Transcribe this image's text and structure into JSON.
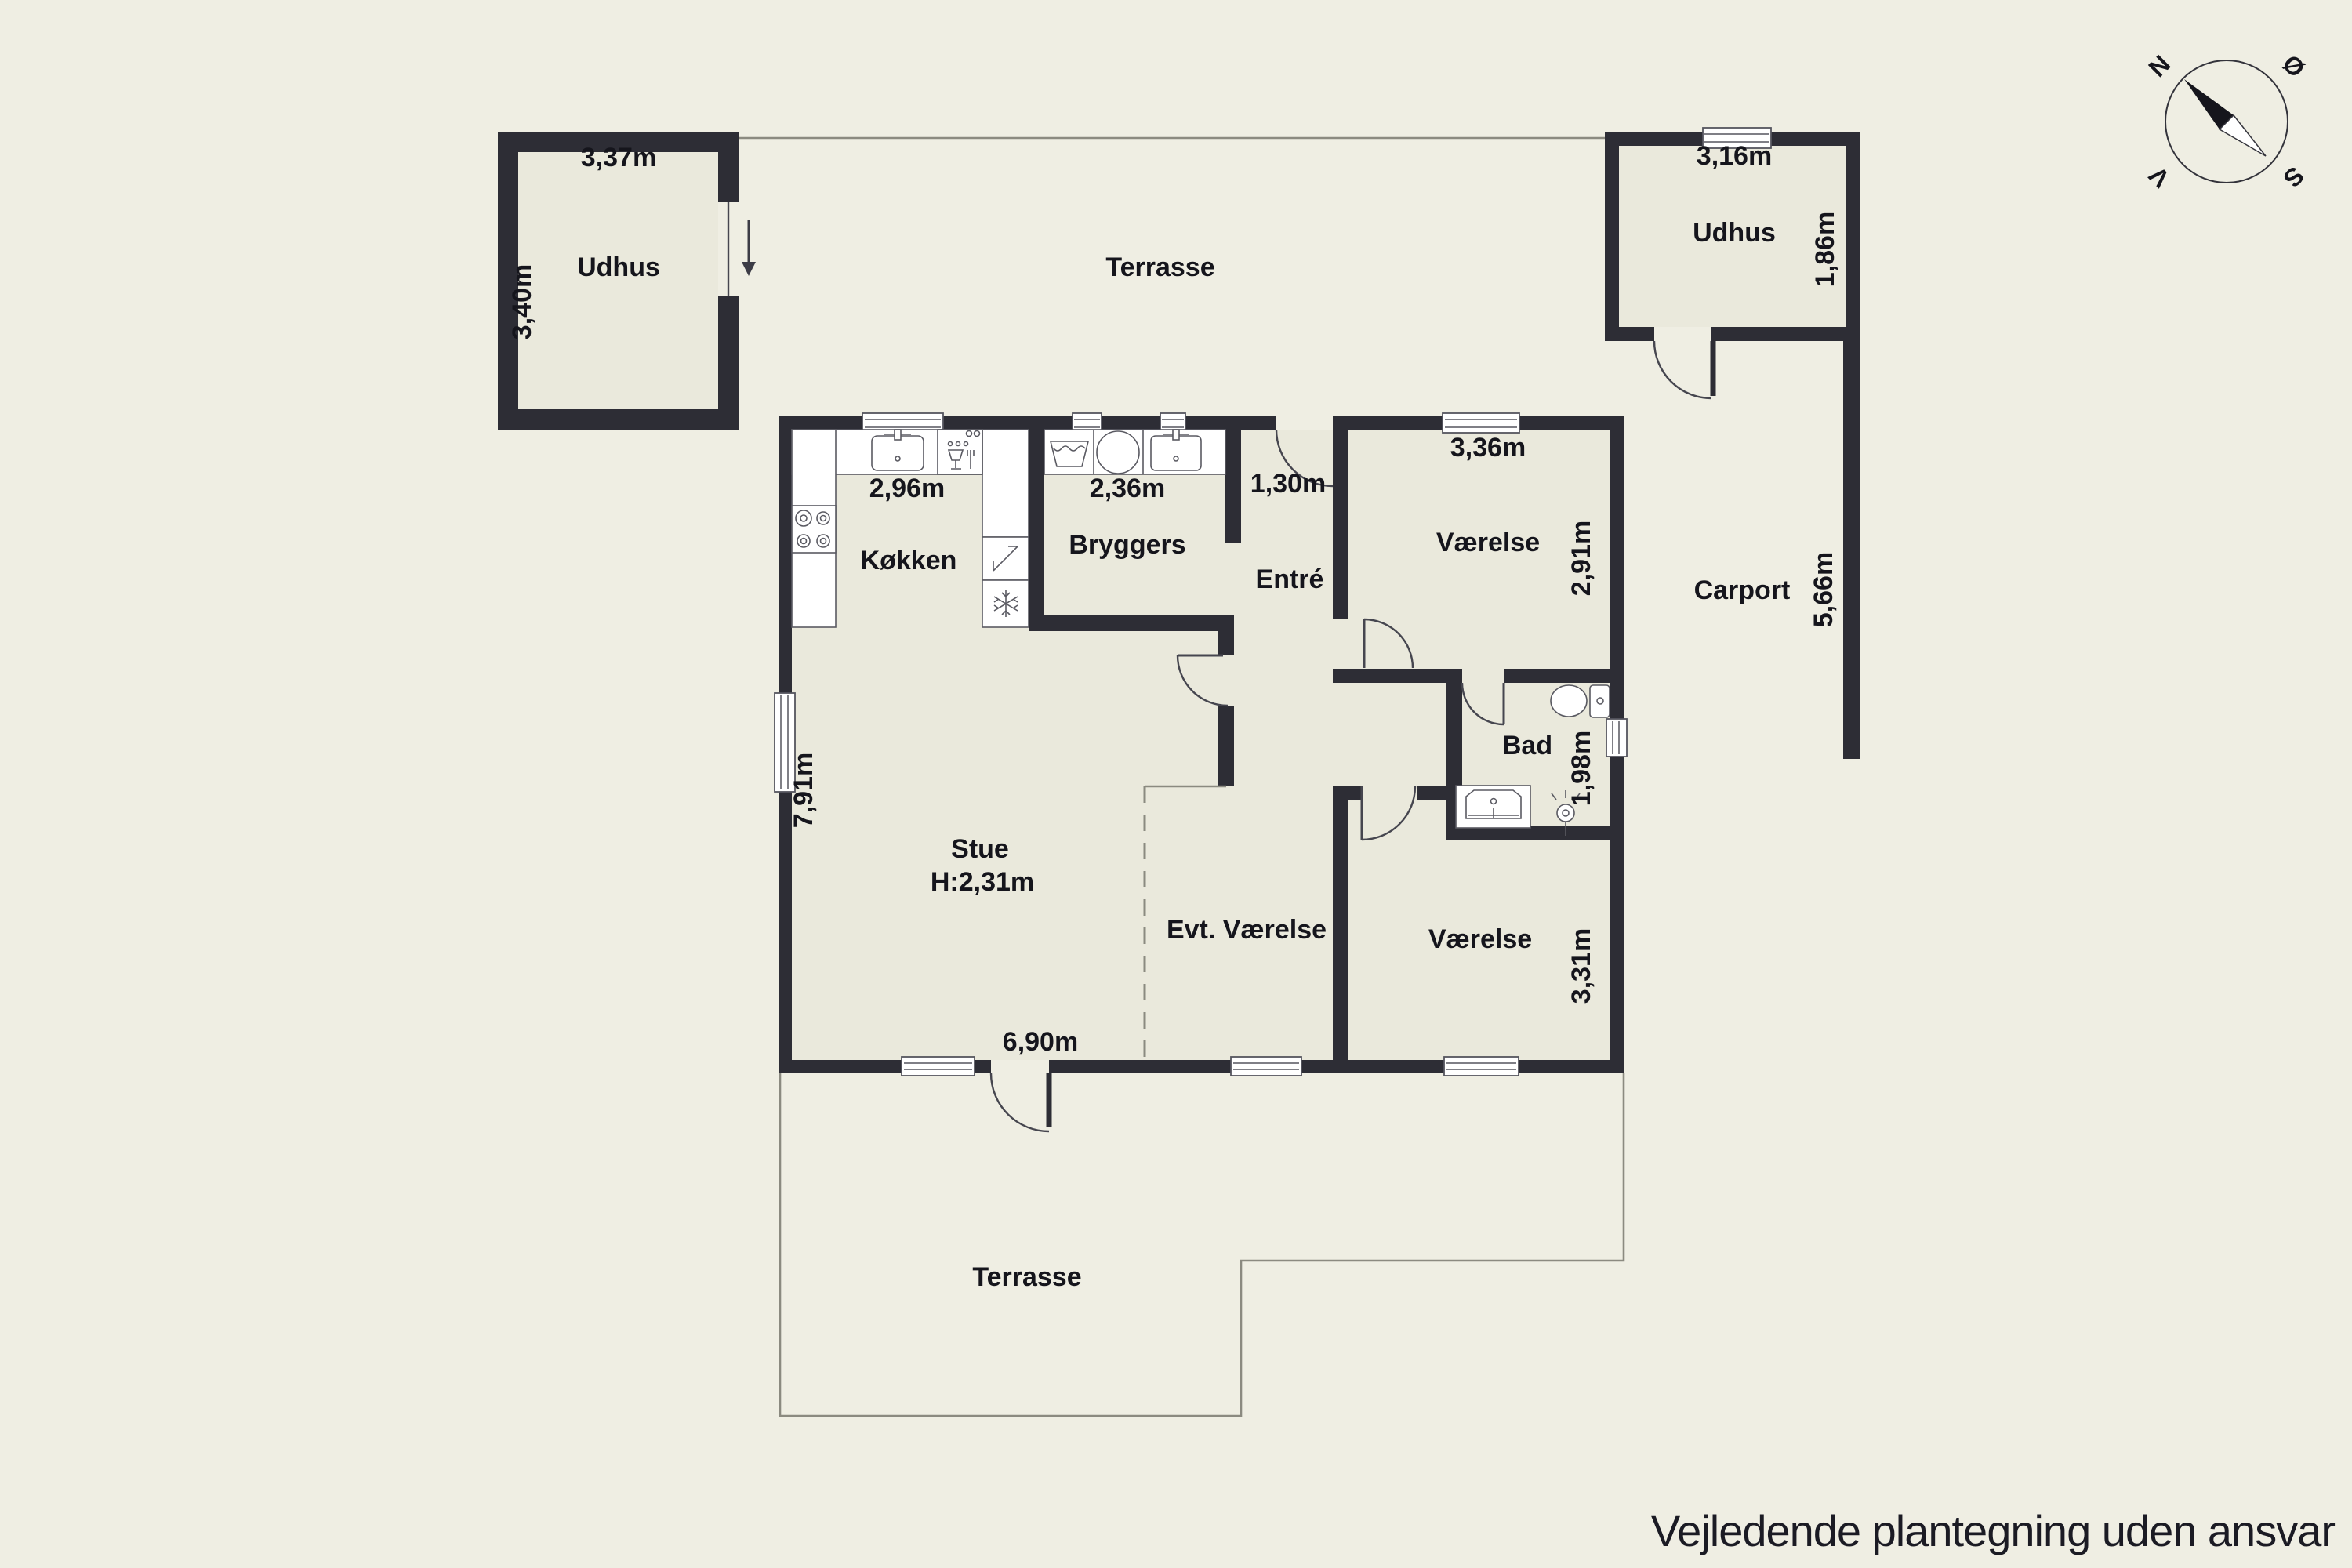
{
  "page": {
    "footer_note": "Vejledende plantegning uden ansvar",
    "background_color": "#efeee3",
    "wall_color": "#2d2d35",
    "room_fill_color": "#eae9dc"
  },
  "compass": {
    "north": "N",
    "east": "Ø",
    "south": "S",
    "west": "V"
  },
  "rooms": {
    "udhus_left": {
      "label": "Udhus",
      "width": "3,37m",
      "depth": "3,40m"
    },
    "terrasse_top": {
      "label": "Terrasse"
    },
    "udhus_right": {
      "label": "Udhus",
      "width": "3,16m",
      "depth": "1,86m"
    },
    "carport": {
      "label": "Carport",
      "length": "5,66m"
    },
    "koekken": {
      "label": "Køkken",
      "width": "2,96m"
    },
    "bryggers": {
      "label": "Bryggers",
      "width": "2,36m"
    },
    "entre": {
      "label": "Entré",
      "width": "1,30m"
    },
    "vaerelse_ne": {
      "label": "Værelse",
      "width": "3,36m",
      "depth": "2,91m"
    },
    "bad": {
      "label": "Bad",
      "depth": "1,98m"
    },
    "stue": {
      "label": "Stue",
      "ceiling_height": "H:2,31m",
      "depth": "7,91m",
      "width": "6,90m"
    },
    "evt_vaerelse": {
      "label": "Evt. Værelse"
    },
    "vaerelse_se": {
      "label": "Værelse",
      "depth": "3,31m"
    },
    "terrasse_bottom": {
      "label": "Terrasse"
    }
  },
  "icons": {
    "compass": "compass-rose-icon",
    "entrance_arrow": "entrance-arrow-icon",
    "kitchen_sink": "kitchen-sink-icon",
    "dishwasher": "dishwasher-icon",
    "stove": "stove-icon",
    "electrical_panel": "electrical-panel-icon",
    "freezer": "freezer-snowflake-icon",
    "laundry_tub": "laundry-tub-icon",
    "washing_machine": "washing-machine-icon",
    "bryggers_sink": "utility-sink-icon",
    "toilet": "toilet-icon",
    "vanity_sink": "vanity-sink-icon",
    "shower": "shower-head-icon"
  }
}
